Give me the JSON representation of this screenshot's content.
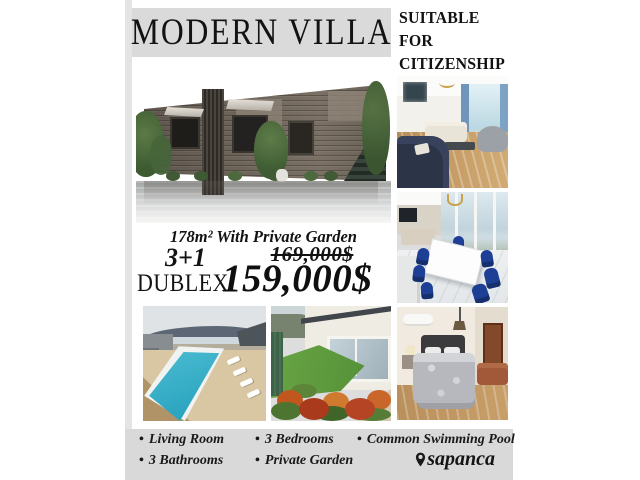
{
  "flyer": {
    "title": "MODERN VILLA",
    "badge": {
      "lines": [
        "SUITABLE",
        "FOR",
        "CITIZENSHIP"
      ]
    },
    "area_text": "178m² With Private Garden",
    "unit": {
      "type": "3+1",
      "layout": "DUBLEX"
    },
    "price": {
      "old": "169,000$",
      "new": "159,000$"
    },
    "bullet": "•",
    "feature_columns": [
      [
        "Living Room",
        "3 Bathrooms"
      ],
      [
        "3 Bedrooms",
        "Private Garden"
      ],
      [
        "Common Swimming Pool"
      ]
    ],
    "location": "sapanca",
    "icons": {
      "location_pin": "location-pin-icon"
    },
    "colors": {
      "band_gray": "#dadada",
      "footer_gray": "#d9d9d9",
      "text": "#161616",
      "pool_turquoise": "#3bb7cd",
      "navy": "#2c3448",
      "grass_green": "#5f9c3f",
      "wood_floor": "#c79e67",
      "brick": "#6b6258"
    }
  }
}
